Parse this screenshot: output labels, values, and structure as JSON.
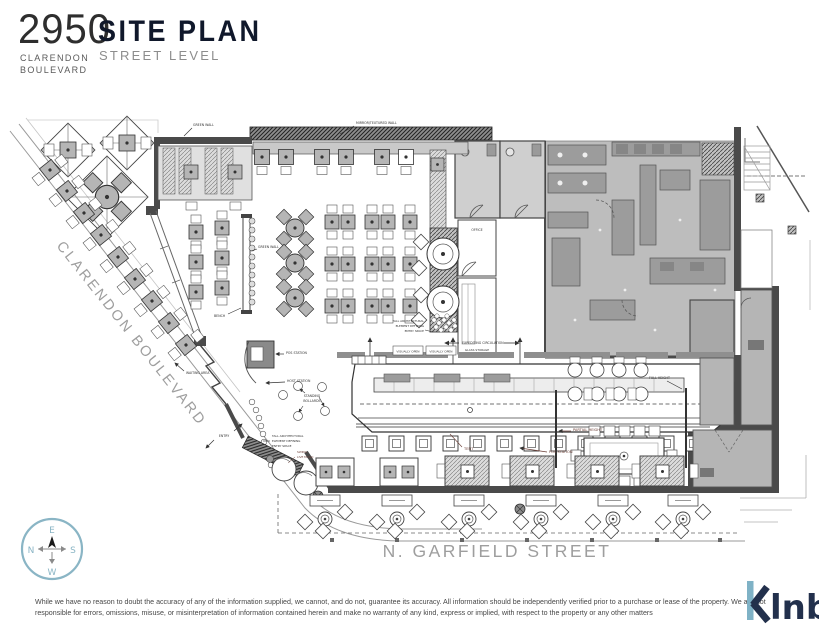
{
  "header": {
    "lot_number": "2950",
    "address_line1": "CLARENDON",
    "address_line2": "BOULEVARD",
    "title": "SITE PLAN",
    "subtitle": "STREET LEVEL"
  },
  "streets": {
    "clarendon": "CLARENDON BOULEVARD",
    "garfield": "N. GARFIELD STREET"
  },
  "plan_labels": {
    "green_wall": "GREEN WALL",
    "mirror_wall": "MIRROR/TEXTURED WALL",
    "bench": "BENCH",
    "waiting_area": "WAITING AREA",
    "pos_station": "POS STATION",
    "host_station": "HOST STATION",
    "standing_1": "STANDING",
    "standing_2": "BOLLARDS",
    "entry": "ENTRY",
    "tall_element": [
      "TALL ARCHITECTURAL",
      "ELEMENT DEFINING",
      "ENTRY SPACE"
    ],
    "swing_1": "SWING",
    "swing_2": "LIVE MUSIC",
    "visually_open": "VISUALLY OPEN",
    "expediting": "EXPEDITING CIRCULATION",
    "tent": "TENT",
    "partial_height": "PARTIAL HEIGHT",
    "full_height": "FULL HEIGHT",
    "office": "OFFICE",
    "glass_storage": "GLASS STORAGE"
  },
  "compass": {
    "north": "N",
    "east": "E",
    "south": "S",
    "west": "W"
  },
  "footer": {
    "disclaimer": "While we have no reason to doubt the accuracy of any of the information supplied, we cannot, and do not, guarantee its accuracy. All information should be independently verified prior to a purchase or lease of the property. We are not responsible for errors, omissions, misuse, or misinterpretation of information contained herein and make no warranty of any kind, express or implied, with respect to the property or any other matters",
    "logo": "klnb",
    "logo_rest": "lnb"
  },
  "colors": {
    "accent_blue": "#85b3c4",
    "logo_navy": "#22304c",
    "plan_gray": "#bdbdbd",
    "annotation_red": "#6d4038"
  }
}
